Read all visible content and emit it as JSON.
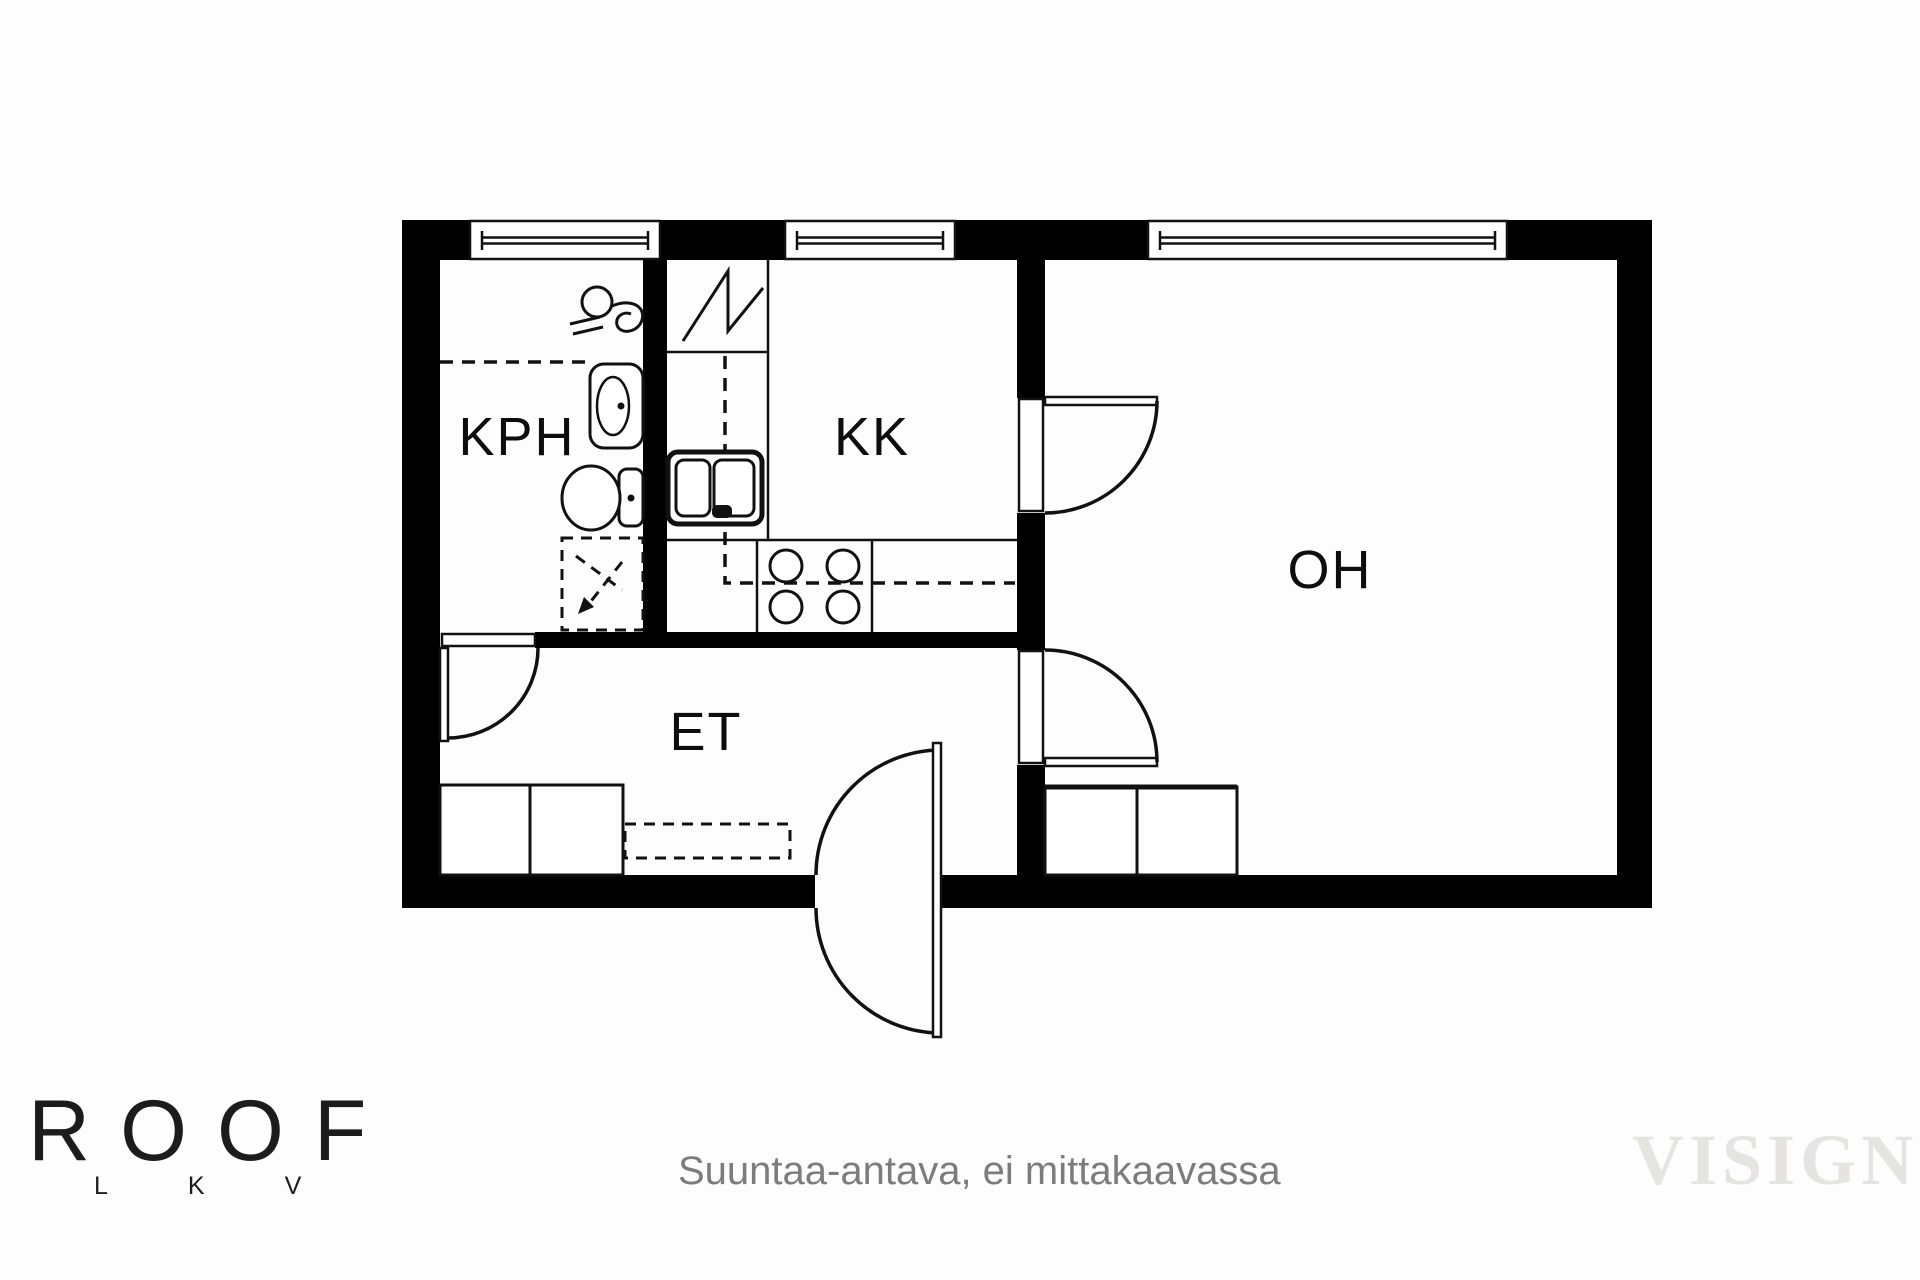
{
  "plan": {
    "room_labels": {
      "kph": "KPH",
      "kk": "KK",
      "oh": "OH",
      "et": "ET"
    },
    "fixture_names": [
      "window",
      "door-swing",
      "shower",
      "washbasin",
      "toilet",
      "washing-machine-reservation",
      "refrigerator",
      "kitchen-sink",
      "stove",
      "wardrobe",
      "coat-rack"
    ]
  },
  "footer": {
    "disclaimer": "Suuntaa-antava, ei mittakaavassa",
    "logo_text": "ROOF",
    "logo_sub": "LKV",
    "watermark": "VISIGN"
  },
  "colors": {
    "wall": "#000000",
    "line": "#111111",
    "bg": "#fdfdfd",
    "room_label": "#0d0d0d",
    "disclaimer": "#7c7c7c",
    "logo": "#1c1c1c",
    "watermark": "#e6e4e1"
  }
}
